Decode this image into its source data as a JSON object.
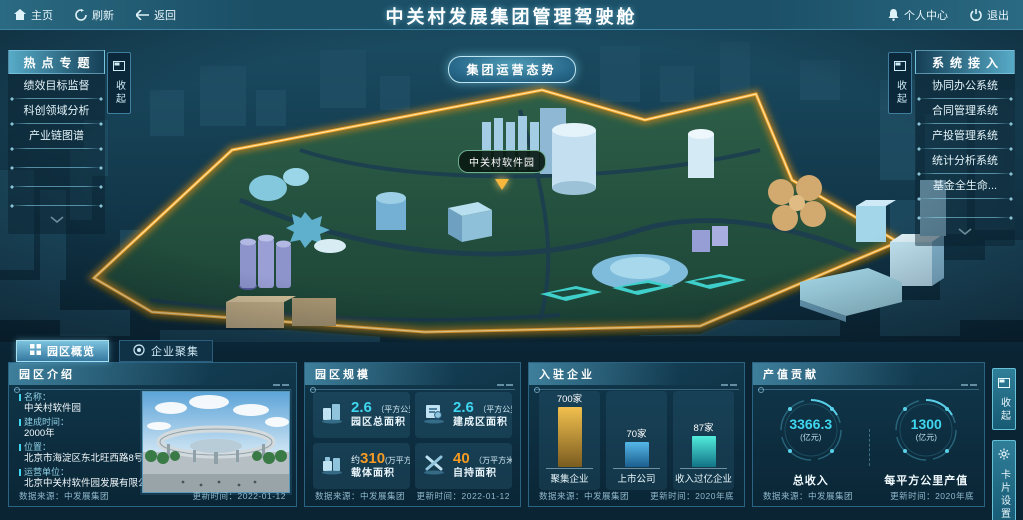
{
  "topbar": {
    "home": "主页",
    "refresh": "刷新",
    "back": "返回",
    "title": "中关村发展集团管理驾驶舱",
    "personal_center": "个人中心",
    "logout": "退出"
  },
  "scene": {
    "overview_button": "集团运营态势",
    "map_label": "中关村软件园"
  },
  "left_panel": {
    "title": "热点专题",
    "collapse": "收起",
    "items": [
      "绩效目标监督",
      "科创领域分析",
      "产业链图谱"
    ]
  },
  "right_panel": {
    "title": "系统接入",
    "collapse": "收起",
    "items": [
      "协同办公系统",
      "合同管理系统",
      "产投管理系统",
      "统计分析系统",
      "基金全生命..."
    ]
  },
  "tabs": {
    "park_overview": "园区概览",
    "enterprise_cluster": "企业聚集"
  },
  "panels": {
    "intro": {
      "title": "园区介绍",
      "fields": [
        {
          "label": "名称：",
          "value": "中关村软件园"
        },
        {
          "label": "建成时间：",
          "value": "2000年"
        },
        {
          "label": "位置：",
          "value": "北京市海淀区东北旺西路8号"
        },
        {
          "label": "运营单位：",
          "value": "北京中关村软件园发展有限公司"
        }
      ],
      "source_label": "数据来源：中发展集团",
      "updated_label": "更新时间：2022-01-12"
    },
    "scale": {
      "title": "园区规模",
      "cells": [
        {
          "prefix": "",
          "value": "2.6",
          "unit": "（平方公里）",
          "label": "园区总面积",
          "icon": "buildings-icon",
          "color": "cyan"
        },
        {
          "prefix": "",
          "value": "2.6",
          "unit": "（平方公里）",
          "label": "建成区面积",
          "icon": "document-icon",
          "color": "cyan"
        },
        {
          "prefix": "约",
          "value": "310",
          "unit": "(万平方米)",
          "label": "载体面积",
          "icon": "factory-icon",
          "color": "orange"
        },
        {
          "prefix": "",
          "value": "40",
          "unit": "（万平方米）",
          "label": "自持面积",
          "icon": "crossed-tools-icon",
          "color": "orange"
        }
      ],
      "source_label": "数据来源：中发展集团",
      "updated_label": "更新时间：2022-01-12"
    },
    "enterprises": {
      "title": "入驻企业",
      "source_label": "数据来源：中发展集团",
      "updated_label": "更新时间：2020年底"
    },
    "output": {
      "title": "产值贡献",
      "stats": [
        {
          "value": "3366.3",
          "unit": "(亿元)",
          "label": "总收入"
        },
        {
          "value": "1300",
          "unit": "(亿元)",
          "label": "每平方公里产值"
        }
      ],
      "source_label": "数据来源：中发展集团",
      "updated_label": "更新时间：2020年底"
    }
  },
  "edge_buttons": {
    "collapse": "收起",
    "card_settings": "卡片设置"
  },
  "colors": {
    "accent_cyan": "#3fd6ef",
    "accent_orange": "#f59a23",
    "park_border_gold": "#f6a82c"
  },
  "chart_data": {
    "type": "bar",
    "title": "入驻企业",
    "categories": [
      "聚集企业",
      "上市公司",
      "收入过亿企业"
    ],
    "values": [
      700,
      70,
      87
    ],
    "unit": "家",
    "value_labels": [
      "700家",
      "70家",
      "87家"
    ],
    "xlabel": "",
    "ylabel": "",
    "legend_position": "none",
    "grid": false,
    "bar_colors": [
      [
        "#f2c04e",
        "#7a5c20"
      ],
      [
        "#55b8e8",
        "#1b5e8e"
      ],
      [
        "#52ecdc",
        "#127386"
      ]
    ],
    "bar_heights_px": [
      67,
      25,
      31
    ]
  }
}
